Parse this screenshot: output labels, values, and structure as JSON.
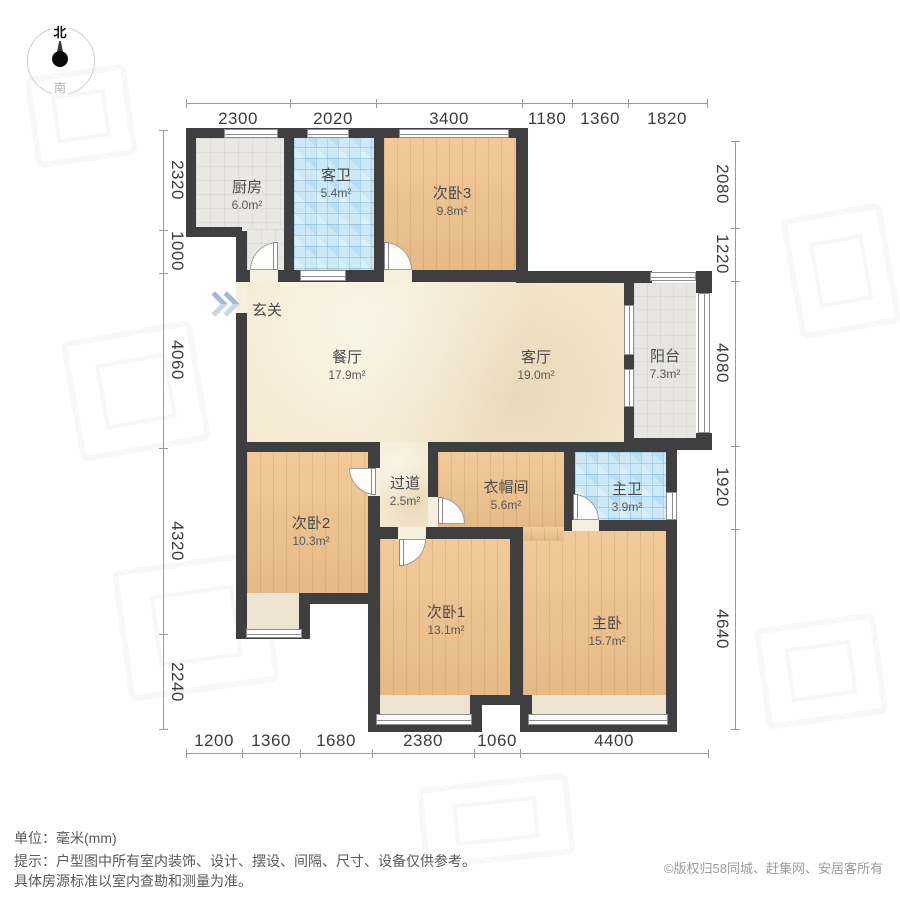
{
  "compass": {
    "north": "北",
    "south": "南"
  },
  "plan": {
    "entry_label": "玄关",
    "rooms": {
      "kitchen": {
        "name": "厨房",
        "area": "6.0m²"
      },
      "guest_bath": {
        "name": "客卫",
        "area": "5.4m²"
      },
      "bedroom3": {
        "name": "次卧3",
        "area": "9.8m²"
      },
      "dining": {
        "name": "餐厅",
        "area": "17.9m²"
      },
      "living": {
        "name": "客厅",
        "area": "19.0m²"
      },
      "balcony": {
        "name": "阳台",
        "area": "7.3m²"
      },
      "bedroom2": {
        "name": "次卧2",
        "area": "10.3m²"
      },
      "hallway": {
        "name": "过道",
        "area": "2.5m²"
      },
      "cloakroom": {
        "name": "衣帽间",
        "area": "5.6m²"
      },
      "master_bath": {
        "name": "主卫",
        "area": "3.9m²"
      },
      "bedroom1": {
        "name": "次卧1",
        "area": "13.1m²"
      },
      "master_bedroom": {
        "name": "主卧",
        "area": "15.7m²"
      }
    },
    "dimensions": {
      "top": [
        "2300",
        "2020",
        "3400",
        "1180",
        "1360",
        "1820"
      ],
      "bottom": [
        "1200",
        "1360",
        "1680",
        "2380",
        "1060",
        "4400"
      ],
      "left": [
        "2320",
        "1000",
        "4060",
        "4320",
        "2240"
      ],
      "right": [
        "2080",
        "1220",
        "4080",
        "1920",
        "4640"
      ]
    }
  },
  "footer": {
    "unit": "单位：毫米(mm)",
    "tip": "提示：户型图中所有室内装饰、设计、摆设、间隔、尺寸、设备仅供参考。",
    "tip2": "具体房源标准以室内查勘和测量为准。",
    "copyright": "©版权归58同城、赶集网、安居客所有"
  },
  "colors": {
    "wall": "#3f3f41",
    "wood_floor": "#f1c48d",
    "marble_floor": "#f4e8cd",
    "blue_tile": "#cde9f7",
    "gray_tile": "#eae8e4",
    "bay_window": "#ece3d1",
    "entry_arrow": "#a4b8d4"
  }
}
